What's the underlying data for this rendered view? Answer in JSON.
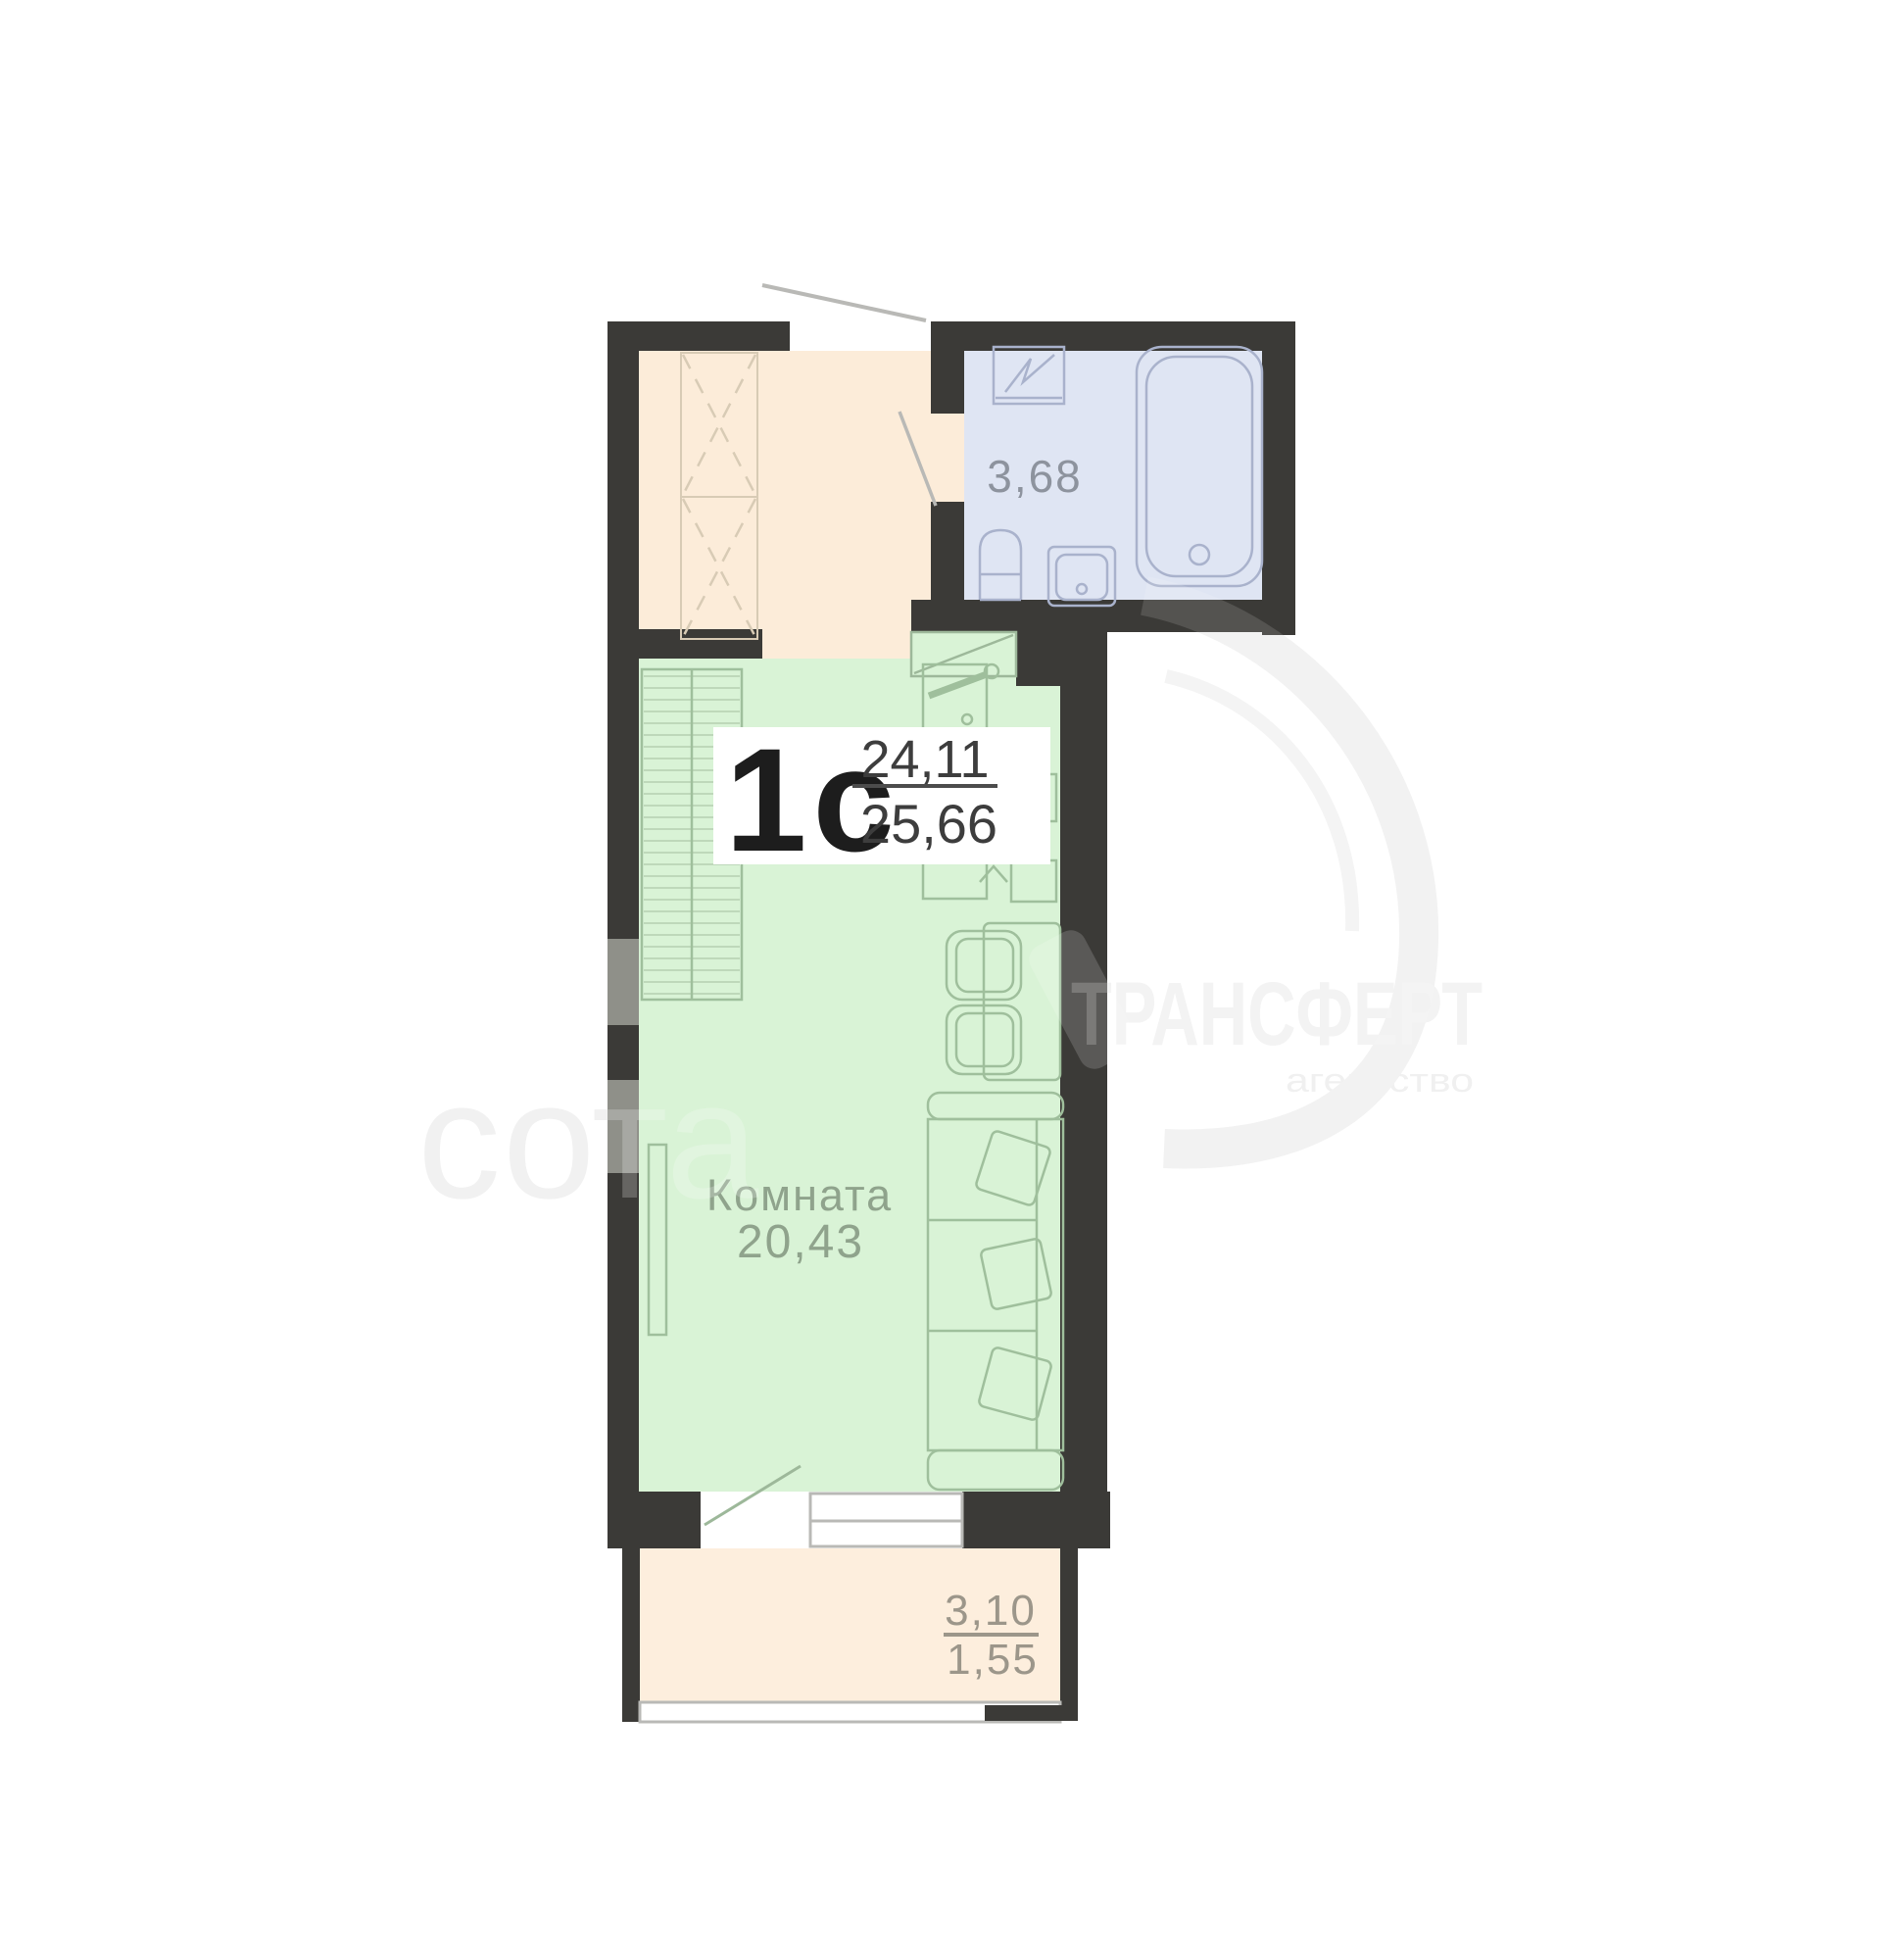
{
  "unit": {
    "type_label": "1с",
    "area_living": "24,11",
    "area_total": "25,66"
  },
  "bathroom": {
    "area": "3,68"
  },
  "room": {
    "name": "Комната",
    "area": "20,43"
  },
  "balcony": {
    "area_full": "3,10",
    "area_half": "1,55"
  },
  "watermark": {
    "brand": "ТРАНСФЕРТ",
    "brand_sub": "агентство",
    "logo": "сота"
  },
  "colors": {
    "wall": "#3b3a37",
    "wall_window": "#8f9089",
    "hall_floor": "#fcecd9",
    "bathroom_floor": "#dfe5f3",
    "room_floor": "#d9f3d6",
    "balcony_floor": "#fdeedd",
    "room_accent": "#9fbf9c",
    "bath_accent": "#a9b2cc",
    "closet_dash": "#d8cbb5",
    "door_line": "#b9b9b6",
    "label_dark": "#1d1d1d",
    "label_gray_blue": "#8d939e",
    "label_gray_green": "#8fa38c",
    "label_gray_tan": "#9c968a",
    "watermark_gray": "#f0f0f0"
  }
}
